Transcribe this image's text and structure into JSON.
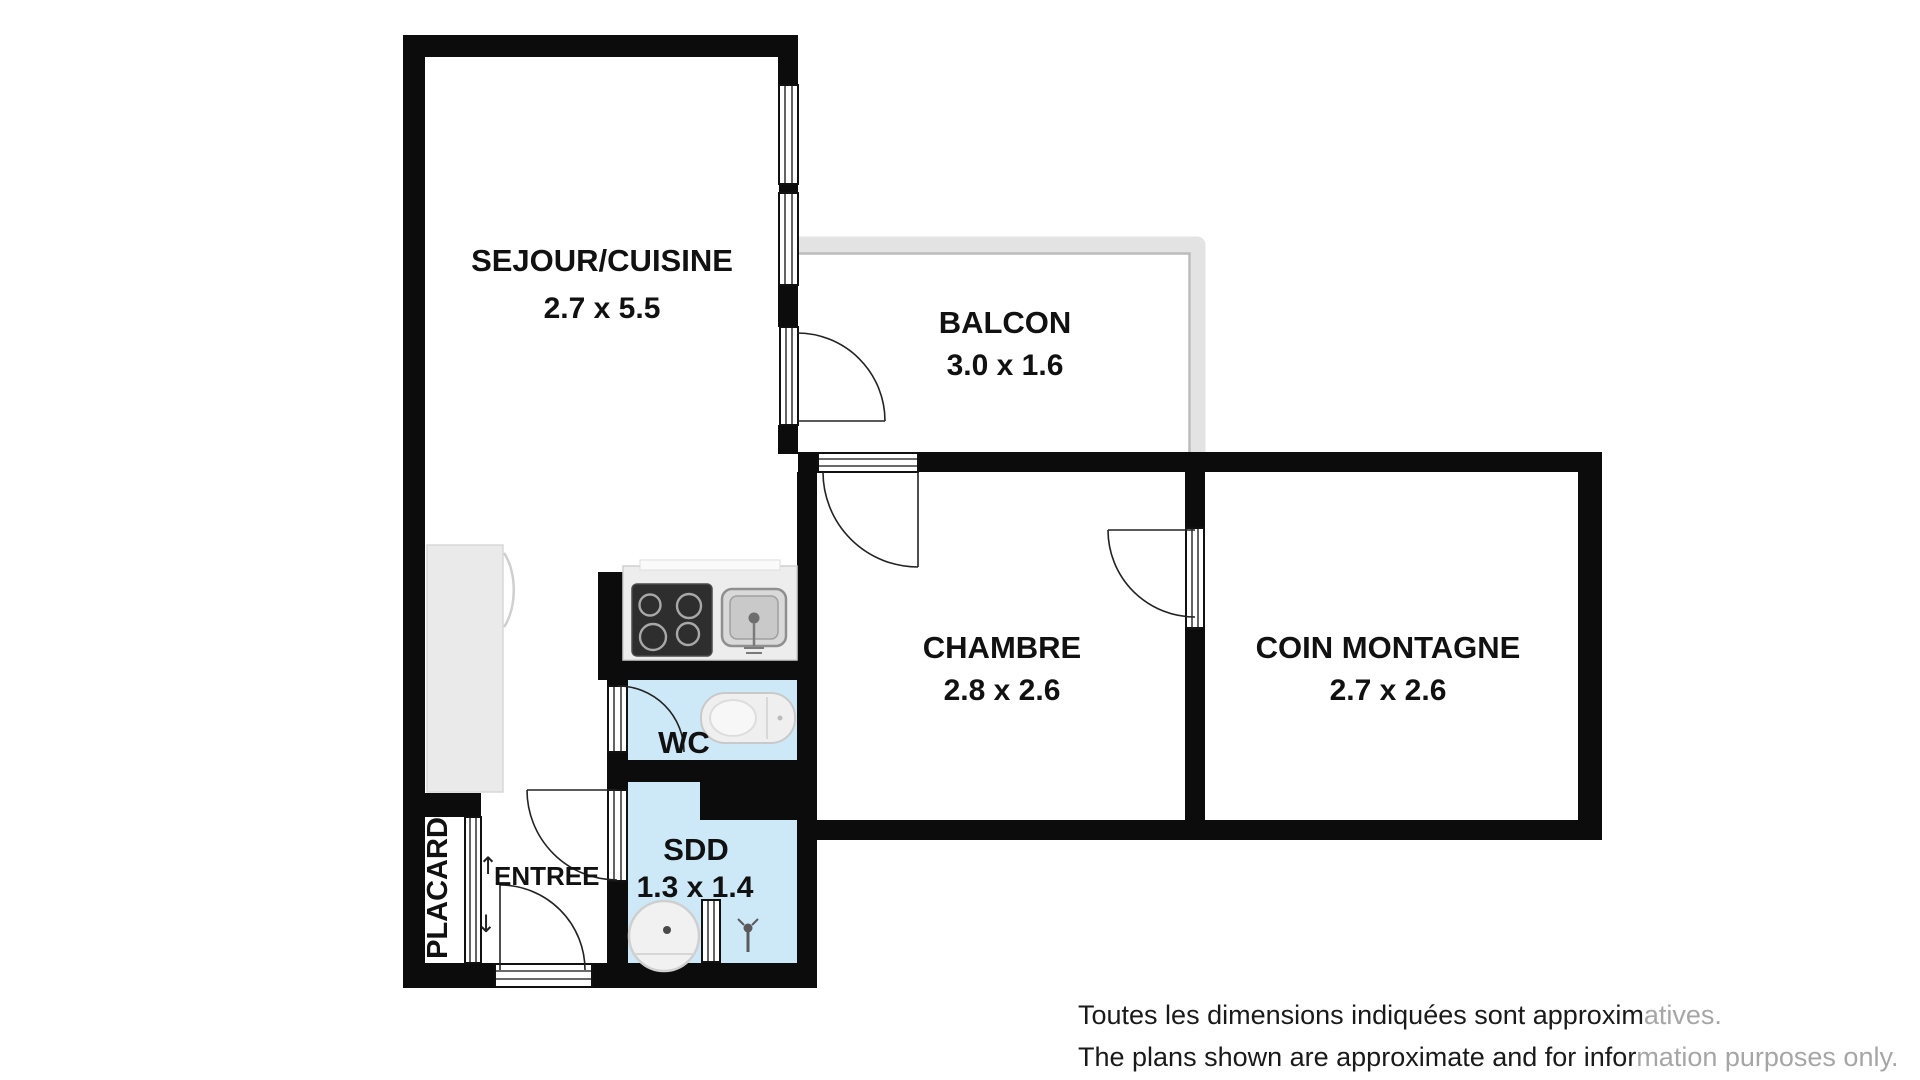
{
  "plan": {
    "title": "Apartment floor plan",
    "rooms": {
      "sejour": {
        "label": "SEJOUR/CUISINE",
        "dims": "2.7 x 5.5"
      },
      "balcon": {
        "label": "BALCON",
        "dims": "3.0 x 1.6"
      },
      "chambre": {
        "label": "CHAMBRE",
        "dims": "2.8 x 2.6"
      },
      "coin": {
        "label": "COIN MONTAGNE",
        "dims": "2.7 x 2.6"
      },
      "wc": {
        "label": "WC"
      },
      "sdd": {
        "label": "SDD",
        "dims": "1.3 x 1.4"
      },
      "placard": {
        "label": "PLACARD"
      },
      "entree": {
        "label": "ENTREE",
        "arrow_up": "↑",
        "arrow_down": "↓"
      }
    },
    "icons": {
      "stove": "stove-cooktop-icon",
      "sink": "kitchen-sink-icon",
      "toilet": "toilet-icon",
      "washbasin": "washbasin-icon",
      "radiator": "towel-radiator-icon",
      "faucet": "shower-faucet-icon",
      "wardrobe": "tall-cabinet-icon"
    }
  },
  "disclaimer": {
    "line1_dark": "Toutes les dimensions indiquées sont approxim",
    "line1_gray": "atives.",
    "line2_dark": "The plans shown are approximate and for infor",
    "line2_gray": "mation purposes only."
  },
  "colors": {
    "wall": "#0c0c0c",
    "wet_floor": "#cde9f8",
    "balcony_rail": "#e3e3e3",
    "balcony_rail_edge": "#bcbcbc",
    "text": "#111111",
    "muted_text": "#a6a6a6"
  }
}
